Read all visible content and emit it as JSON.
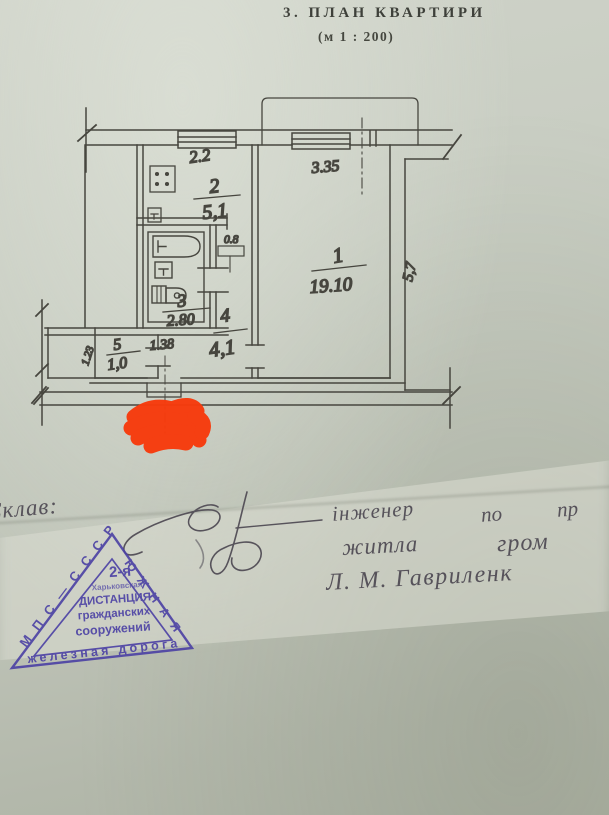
{
  "page": {
    "title": "3. ПЛАН КВАРТИРИ",
    "scale": "(м 1 : 200)"
  },
  "plan": {
    "room1": {
      "number": "1",
      "area": "19.10",
      "width": "3.35",
      "depth": "5,7"
    },
    "room2": {
      "number": "2",
      "area": "5,1",
      "width": "2.2"
    },
    "room3": {
      "number": "3",
      "area": "2.80",
      "width": "1.38"
    },
    "room4": {
      "number": "4",
      "area": "4,1"
    },
    "room5": {
      "number": "5",
      "area": "1,0",
      "depth": "1.23"
    },
    "duct_width": "0.8",
    "line_color": "#47463f"
  },
  "handwriting": {
    "label": "Склав:",
    "line1_word1": "інженер",
    "line1_word2": "по",
    "line1_word3": "пр",
    "line2_word1": "житла",
    "line2_word2": "гром",
    "line3": "Л. М. Гавриленк",
    "ink_color": "#56525a"
  },
  "stamp": {
    "left_edge": "МПС—СССР",
    "right_edge": "ЮЖНАЯ",
    "center_line1": "2-я",
    "center_line2": "Харьковская",
    "center_line3": "ДИСТАНЦИЯ",
    "center_line4": "гражданских",
    "center_line5": "сооружений",
    "bottom_edge": "железная дорога",
    "ink_color": "#4b40a4"
  },
  "redaction": {
    "color": "#f73b0d"
  }
}
